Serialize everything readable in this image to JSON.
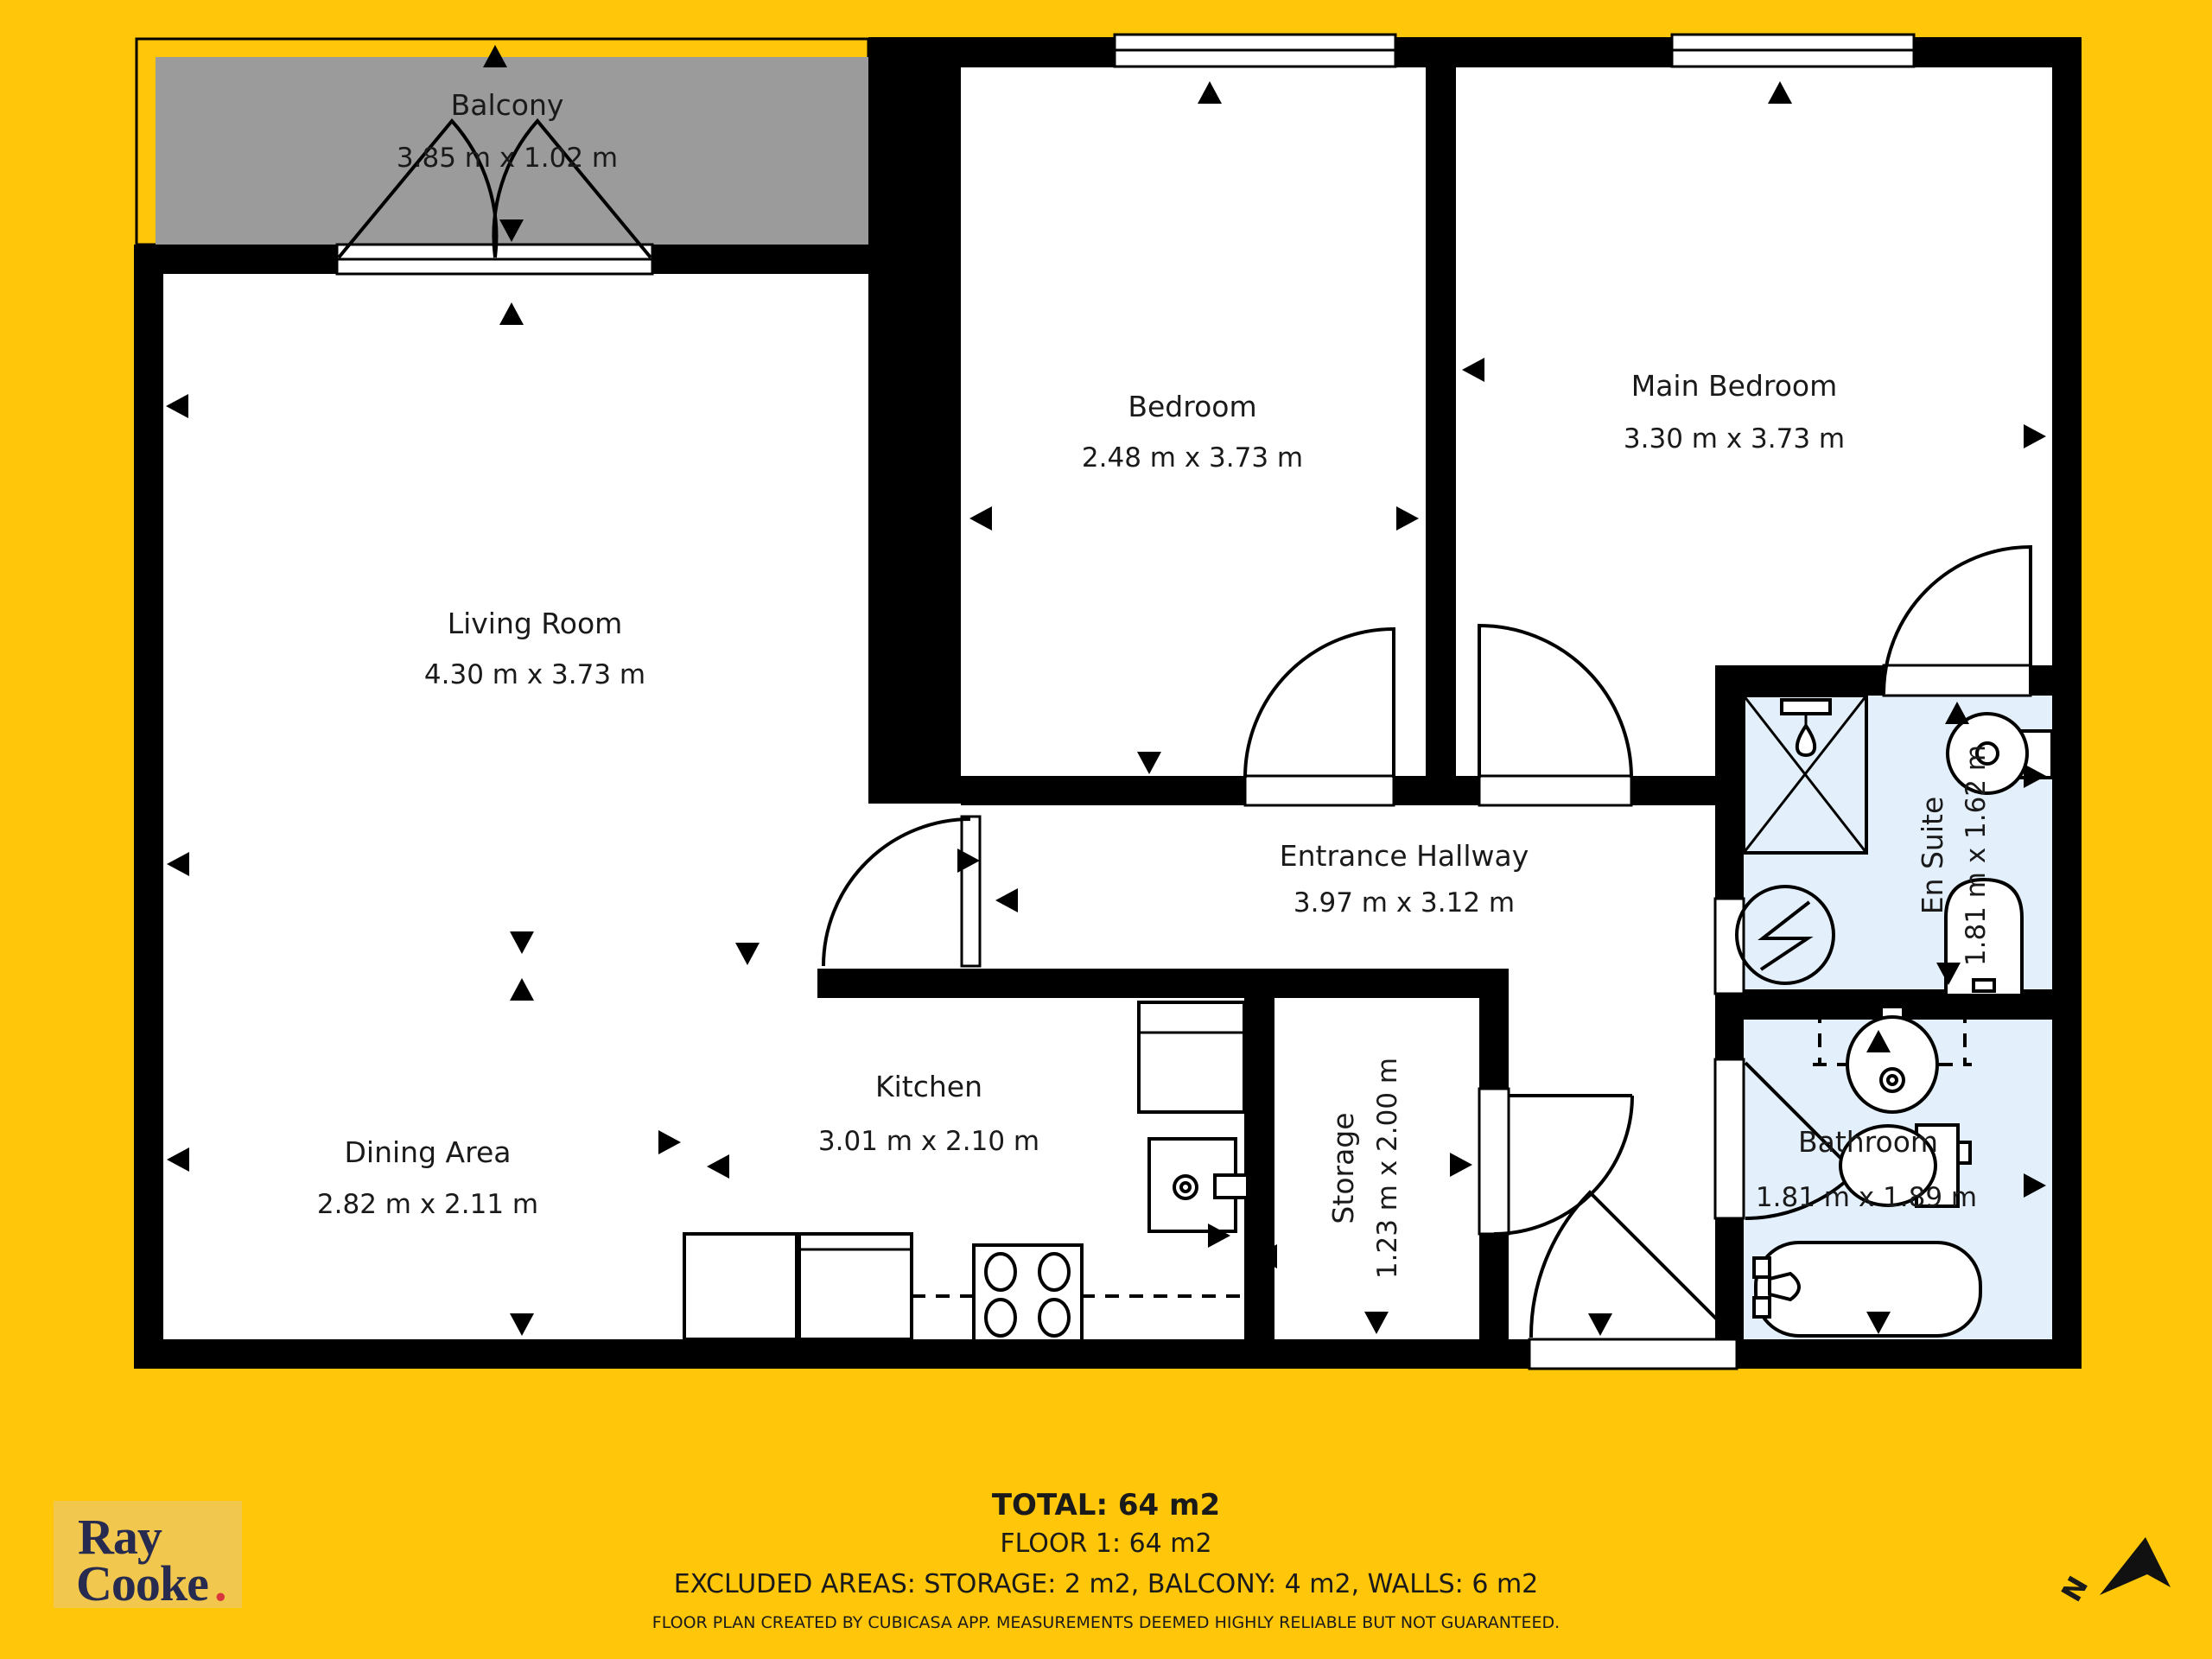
{
  "colors": {
    "background": "#FFC60A",
    "walls": "#000000",
    "balcony_floor": "#9B9B9B",
    "wet_room_floor": "#E3EFFA",
    "room_floor": "#FFFFFF",
    "logo_text": "#272B4F",
    "logo_dot": "#D8353C"
  },
  "rooms": {
    "balcony": {
      "name": "Balcony",
      "dims": "3.85 m x 1.02 m"
    },
    "living": {
      "name": "Living Room",
      "dims": "4.30 m x 3.73 m"
    },
    "dining": {
      "name": "Dining Area",
      "dims": "2.82 m x 2.11 m"
    },
    "kitchen": {
      "name": "Kitchen",
      "dims": "3.01 m x 2.10 m"
    },
    "bedroom": {
      "name": "Bedroom",
      "dims": "2.48 m x 3.73 m"
    },
    "main_bedroom": {
      "name": "Main Bedroom",
      "dims": "3.30 m x 3.73 m"
    },
    "hallway": {
      "name": "Entrance Hallway",
      "dims": "3.97 m x 3.12 m"
    },
    "storage": {
      "name": "Storage",
      "dims": "1.23 m x 2.00 m"
    },
    "en_suite": {
      "name": "En Suite",
      "dims": "1.81 m x 1.62 m"
    },
    "bathroom": {
      "name": "Bathroom",
      "dims": "1.81 m x 1.89 m"
    }
  },
  "footer": {
    "total": "TOTAL: 64 m2",
    "floor": "FLOOR 1: 64 m2",
    "excluded": "EXCLUDED AREAS: STORAGE: 2 m2, BALCONY: 4 m2, WALLS: 6 m2",
    "disclaimer": "FLOOR PLAN CREATED BY CUBICASA APP. MEASUREMENTS DEEMED HIGHLY RELIABLE BUT NOT GUARANTEED."
  },
  "logo": {
    "line1": "Ray",
    "line2": "Cooke",
    "dot": "."
  },
  "compass": {
    "label": "N"
  }
}
